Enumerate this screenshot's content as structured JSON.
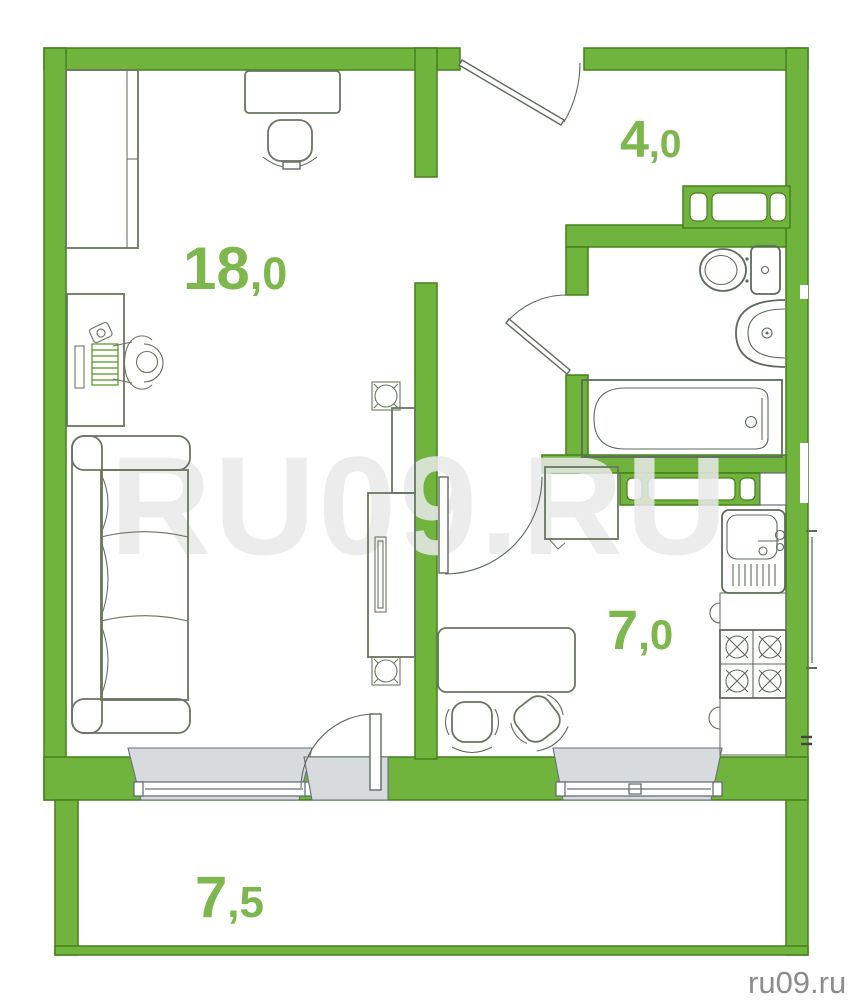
{
  "watermark": {
    "center_text": "RU09.RU",
    "site_credit": "ru09.ru"
  },
  "rooms": {
    "living": {
      "area": "18,0",
      "area_int": "18",
      "area_dec": ",0"
    },
    "hallway": {
      "area": "4,0",
      "area_int": "4",
      "area_dec": ",0"
    },
    "kitchen": {
      "area": "7,0",
      "area_int": "7",
      "area_dec": ",0"
    },
    "balcony": {
      "area": "7,5",
      "area_int": "7",
      "area_dec": ",5"
    }
  },
  "furniture_icons": [
    "wardrobe",
    "dressing-table",
    "stool",
    "desk",
    "person-at-desk",
    "sofa",
    "tv-stand",
    "speaker",
    "hallway-closet",
    "toilet",
    "wash-basin",
    "bathtub",
    "fridge",
    "dining-table",
    "chair",
    "kitchen-sink",
    "kitchen-counter",
    "stove",
    "window",
    "door"
  ],
  "colors": {
    "wall_green": "#70b43e",
    "wall_outline": "#46801b",
    "label_green": "#7db74e",
    "furniture_line": "#6a7661",
    "fixture_line": "#5d6b5d",
    "window_gray": "#d7dbde",
    "window_line": "#687077",
    "watermark_gray": "#e9e9e9",
    "credit_gray": "#8c8c8c",
    "keyboard_green": "#55941d"
  }
}
